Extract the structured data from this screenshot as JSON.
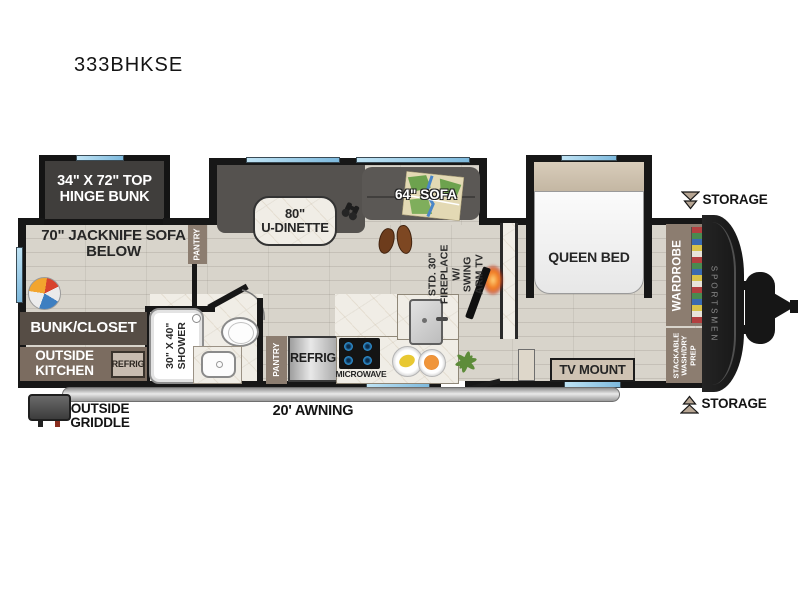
{
  "title": "333BHKSE",
  "colors": {
    "wall": "#171717",
    "window_blue": "#7db9dd",
    "floor_wood": "#d8d4cb",
    "marble": "#f0ede6",
    "cabinet_brown": "#8c7d70",
    "dark_brown": "#564d45",
    "label_tan": "#cfc3b3",
    "flame_orange": "#f07820"
  },
  "labels": {
    "bunk": "34\" X 72\" TOP\nHINGE BUNK",
    "jacknife": "70\" JACKNIFE SOFA\nBELOW",
    "pantry_front": "PANTRY",
    "dinette": "80\"\nU-DINETTE",
    "sofa": "64\" SOFA",
    "fireplace": "STD. 30\"\nFIREPLACE W/\nSWING ARM TV",
    "queen_bed": "QUEEN BED",
    "storage_top": "STORAGE",
    "storage_bottom": "STORAGE",
    "wardrobe": "WARDROBE",
    "stackable": "STACKABLE\nWASH/DRY\nPREP",
    "brand": "SPORTSMEN",
    "bunk_closet": "BUNK/CLOSET",
    "outside_kitchen": "OUTSIDE\nKITCHEN",
    "outside_kitchen_refrig": "REFRIG",
    "shower": "30\" X 40\"\nSHOWER",
    "pantry_kitchen": "PANTRY",
    "refrig": "REFRIG",
    "microwave": "MICROWAVE",
    "tv_mount": "TV MOUNT",
    "awning": "20' AWNING",
    "griddle": "OUTSIDE\nGRIDDLE"
  }
}
